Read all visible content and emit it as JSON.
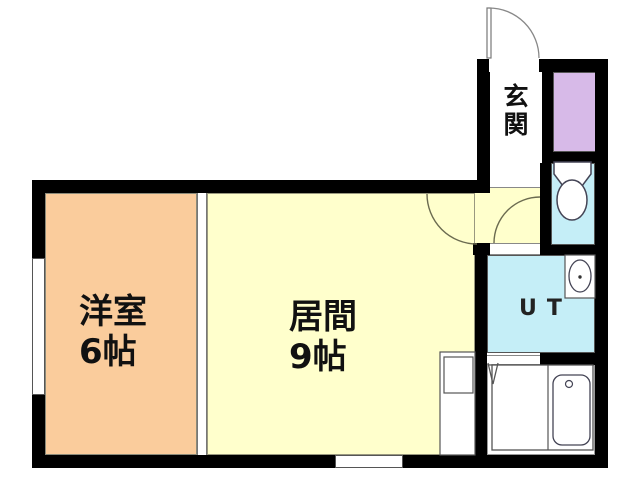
{
  "plan": {
    "title": "apartment-floor-plan",
    "rooms": {
      "western": {
        "label": "洋室",
        "size": "6帖",
        "color": "#FACC9C"
      },
      "living": {
        "label": "居間",
        "size": "9帖",
        "color": "#FFFFCC"
      },
      "entrance": {
        "label": "玄関",
        "color": "#FFFFFF"
      },
      "utility": {
        "label": "UT",
        "color": "#C5EEF7"
      },
      "toilet": {
        "label": "",
        "color": "#C5EEF7"
      },
      "closet": {
        "label": "",
        "color": "#D7BAE8"
      },
      "bathroom": {
        "label": "",
        "color": "#FFFFFF"
      }
    },
    "fixtures": {
      "toilet": "toilet-icon",
      "washbasin": "washbasin-icon",
      "bathtub": "bathtub-icon",
      "kitchen_counter": "kitchen-counter-icon",
      "entry_door": "entry-door-arc",
      "living_door": "living-door-arc",
      "hallway_door": "hallway-door-arc",
      "folding_door": "folding-door-mark"
    },
    "colors": {
      "wall": "#000000",
      "western_room": "#FACC9C",
      "living_room": "#FFFFCC",
      "water_rooms": "#C5EEF7",
      "closet": "#D7BAE8",
      "outline": "#555555",
      "background": "#FFFFFF"
    }
  }
}
